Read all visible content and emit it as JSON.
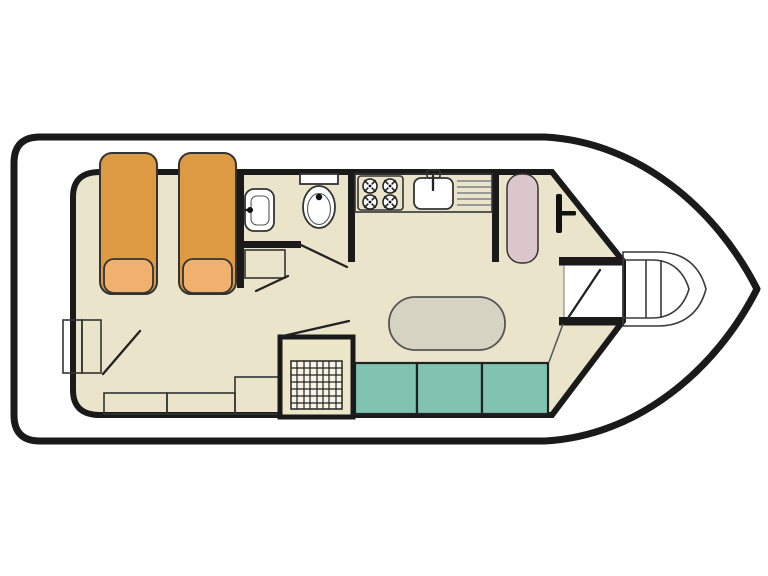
{
  "canvas": {
    "width": 768,
    "height": 576,
    "background": "#ffffff"
  },
  "colors": {
    "outline": "#1a1a1a",
    "wall": "#1a1a1a",
    "hull_fill": "#ffffff",
    "floor": "#e9e4ca",
    "bed_orange": "#df9a44",
    "pillow_orange": "#f0b06e",
    "bench_teal": "#80c4b0",
    "helm_seat_pink": "#dbc7cb",
    "furniture_gray": "#d8d7c9",
    "table_gray": "#d6d3c3",
    "shower_floor": "#ece7c9",
    "grid_white": "#f8f5e6",
    "deck_gray": "#dcd9ce",
    "fixture_white": "#ffffff",
    "drainer_gray": "#999999",
    "hardware_black": "#111111"
  },
  "features": [
    {
      "id": "hull",
      "label": "boat hull"
    },
    {
      "id": "cabin",
      "label": "cabin floor"
    },
    {
      "id": "stern-deck",
      "label": "stern deck"
    },
    {
      "id": "stern-steps",
      "label": "stern entry steps"
    },
    {
      "id": "berth-left",
      "label": "single berth"
    },
    {
      "id": "berth-right",
      "label": "single berth"
    },
    {
      "id": "wardrobe-cabinets",
      "label": "storage cabinets"
    },
    {
      "id": "washbasin",
      "label": "washbasin"
    },
    {
      "id": "toilet",
      "label": "toilet"
    },
    {
      "id": "shower",
      "label": "shower cubicle"
    },
    {
      "id": "galley-counter",
      "label": "galley counter"
    },
    {
      "id": "stove",
      "label": "four burner stove"
    },
    {
      "id": "sink",
      "label": "sink with drainer"
    },
    {
      "id": "helm-seat",
      "label": "helm seat"
    },
    {
      "id": "steering-gear",
      "label": "steering position"
    },
    {
      "id": "dinette-table",
      "label": "saloon table"
    },
    {
      "id": "bench-seat",
      "label": "three cushion bench seat"
    },
    {
      "id": "bow-vestibule",
      "label": "bow doorway"
    },
    {
      "id": "bow-deck",
      "label": "bow deck steps"
    }
  ]
}
